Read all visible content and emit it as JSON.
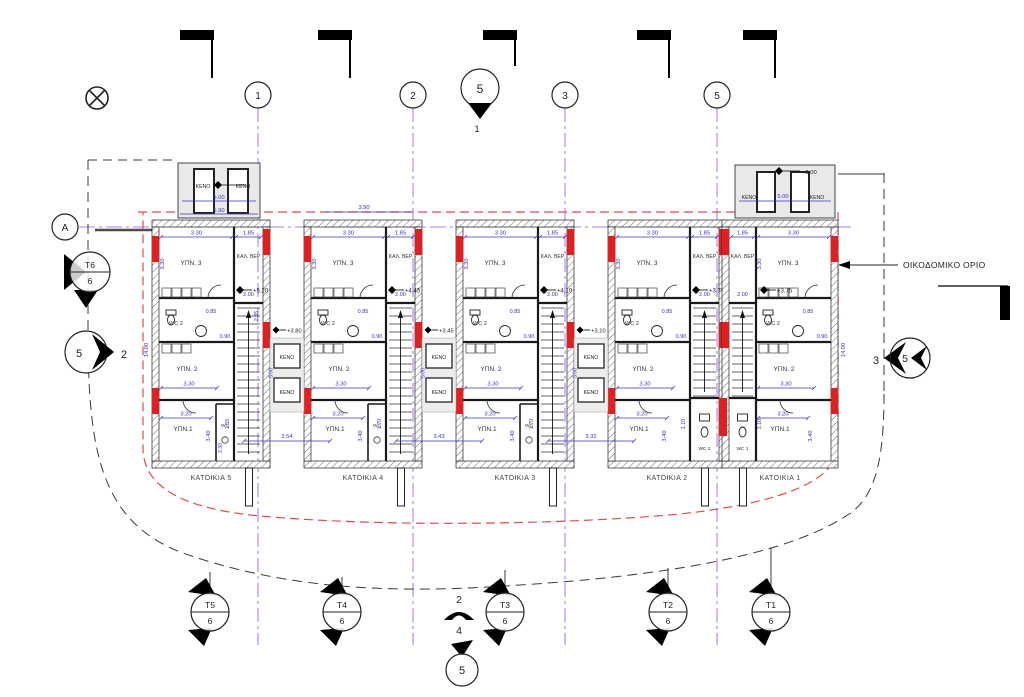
{
  "drawing": {
    "boundary_label": "ΟΙΚΟΔΟΜΙΚΟ ΟΡΙΟ"
  },
  "colors": {
    "grid_purple": "#b07df2",
    "dimension_blue": "#3434bb",
    "boundary_red": "#e14b4b",
    "wall_accent_red": "#e01f1f"
  },
  "grid": {
    "row_bubble": "A",
    "top_bubbles": [
      {
        "label": "1"
      },
      {
        "label": "2"
      },
      {
        "label": "3"
      },
      {
        "label": "5"
      }
    ],
    "section_top": {
      "circle": "5",
      "ref": "1"
    },
    "section_bottom": {
      "num_top": "2",
      "num_mid": "4",
      "circle": "5"
    }
  },
  "markers": {
    "left_section": {
      "top": "T6",
      "bottom": "6"
    },
    "left_detail": {
      "circle": "5",
      "ref": "2"
    },
    "right_detail": {
      "ref": "3",
      "circle": "5"
    },
    "bottom_sections": [
      {
        "top": "T5",
        "bottom": "6"
      },
      {
        "top": "T4",
        "bottom": "6"
      },
      {
        "top": "T3",
        "bottom": "6"
      },
      {
        "top": "T2",
        "bottom": "6"
      },
      {
        "top": "T1",
        "bottom": "6"
      }
    ]
  },
  "roof_voids": {
    "left": {
      "a": "ΚΕΝΟ",
      "b": "ΚΕΝΟ",
      "dim": "5.00",
      "width_dim": "5.90"
    },
    "right": {
      "a": "ΚΕΝΟ",
      "b": "ΚΕΝΟ",
      "dim": "5.00",
      "level": "+2.00"
    }
  },
  "top_dims": {
    "unit4": "3.90"
  },
  "side_dims": {
    "left": "14.00",
    "right": "14.00",
    "mid": "14.00"
  },
  "units": [
    {
      "name": "ΚΑΤΟΙΚΙΑ 5",
      "level": "+5.20",
      "rooms": {
        "bed3": "ΥΠΝ. 3",
        "veranda": "ΚΑΛ. ΒΕΡ",
        "wc2": "WC 2",
        "bed2": "ΥΠΝ. 2",
        "bed1": "ΥΠΝ.1",
        "wc": "WC"
      },
      "dims": {
        "top": "3.30",
        "ver": "1.85",
        "left": "3.30",
        "bed2": "3.30",
        "bed1": "3.20",
        "bed1_h": "3.40",
        "wc_a": "0.85",
        "wc_b": "0.90",
        "ver_a": "2.00",
        "ver_b": "2.35",
        "stair": "1.55",
        "wcs": "2.30"
      }
    },
    {
      "name": "ΚΑΤΟΙΚΙΑ 4",
      "level": "+4.45",
      "rooms": {
        "bed3": "ΥΠΝ. 3",
        "veranda": "ΚΑΛ. ΒΕΡ",
        "wc2": "WC 2",
        "bed2": "ΥΠΝ. 2",
        "bed1": "ΥΠΝ.1",
        "wc": "WC"
      },
      "dims": {
        "top": "3.30",
        "ver": "1.85",
        "left": "3.30",
        "bed2": "3.30",
        "bed1": "3.20",
        "bed1_h": "3.40",
        "wc_a": "0.85",
        "wc_b": "0.90",
        "ver_a": "2.00",
        "stair": "1.70"
      }
    },
    {
      "name": "ΚΑΤΟΙΚΙΑ 3",
      "level": "+4.10",
      "rooms": {
        "bed3": "ΥΠΝ. 3",
        "veranda": "ΚΑΛ. ΒΕΡ",
        "wc2": "WC 2",
        "bed2": "ΥΠΝ. 2",
        "bed1": "ΥΠΝ.1",
        "wc": "WC"
      },
      "dims": {
        "top": "3.30",
        "ver": "1.85",
        "left": "3.30",
        "bed2": "3.30",
        "bed1": "3.20",
        "bed1_h": "3.40",
        "wc_a": "0.85",
        "wc_b": "0.90",
        "ver_a": "2.00",
        "stair": "1.70"
      }
    },
    {
      "name": "ΚΑΤΟΙΚΙΑ 2",
      "level": "+3.75",
      "rooms": {
        "bed3": "ΥΠΝ. 3",
        "veranda": "ΚΑΛ. ΒΕΡ",
        "wc2": "WC 2",
        "bed2": "ΥΠΝ. 2",
        "bed1": "ΥΠΝ.1",
        "wc": "WC 2"
      },
      "dims": {
        "top": "3.30",
        "ver": "1.85",
        "left": "3.30",
        "bed2": "3.30",
        "bed1": "3.20",
        "bed1_h": "3.40",
        "wc_a": "0.85",
        "wc_b": "0.90",
        "ver_a": "2.00",
        "stair": "1.10"
      }
    },
    {
      "name": "ΚΑΤΟΙΚΙΑ 1",
      "level": "+3.75",
      "rooms": {
        "bed3": "ΥΠΝ. 3",
        "veranda": "ΚΑΛ. ΒΕΡ",
        "wc2": "WC 2",
        "bed2": "ΥΠΝ. 2",
        "bed1": "ΥΠΝ.1",
        "wc": "WC 1"
      },
      "dims": {
        "top": "3.30",
        "ver": "1.85",
        "left": "3.30",
        "bed2": "3.30",
        "bed1": "3.20",
        "bed1_h": "3.40",
        "wc_a": "0.85",
        "wc_b": "0.90",
        "ver_a": "2.00",
        "stair": "1.10"
      }
    }
  ],
  "voids": [
    {
      "a": "ΚΕΝΟ",
      "b": "ΚΕΝΟ",
      "v": "5.00",
      "level": "+3.80",
      "bottom": "3.54"
    },
    {
      "a": "ΚΕΝΟ",
      "b": "ΚΕΝΟ",
      "v": "5.00",
      "level": "+3.45",
      "bottom": "3.43"
    },
    {
      "a": "ΚΕΝΟ",
      "b": "ΚΕΝΟ",
      "v": "5.00",
      "level": "+3.10",
      "bottom": "3.32"
    }
  ]
}
